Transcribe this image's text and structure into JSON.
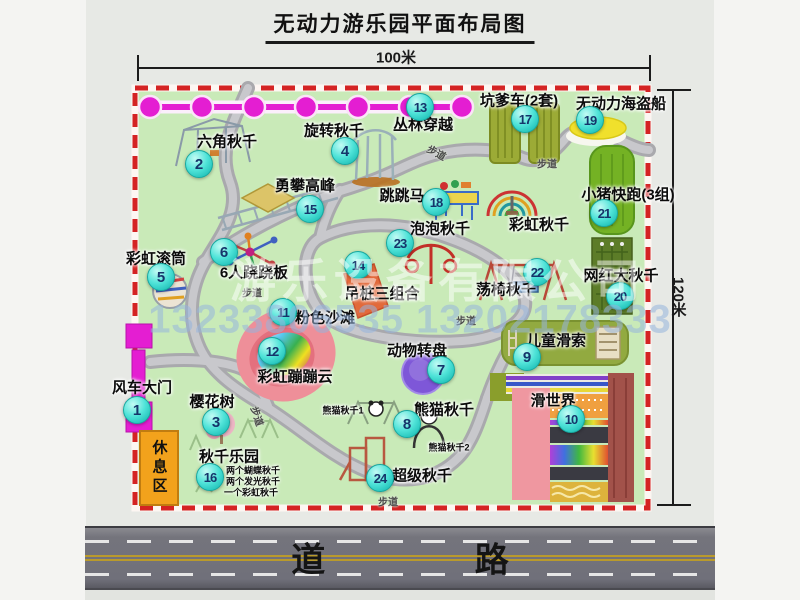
{
  "header": {
    "title": "无动力游乐园平面布局图"
  },
  "dims": {
    "width": "100米",
    "height": "120米"
  },
  "road": {
    "label": "道 路"
  },
  "watermark": {
    "company": "游乐设备有限公司",
    "phones": "13233806535 13202178333"
  },
  "rest_area": {
    "label": "休息区"
  },
  "attractions": [
    {
      "num": "1",
      "name": "风车大门",
      "mx": 137,
      "my": 410,
      "lx": 142,
      "ly": 387
    },
    {
      "num": "2",
      "name": "六角秋千",
      "mx": 199,
      "my": 164,
      "lx": 227,
      "ly": 141
    },
    {
      "num": "3",
      "name": "樱花树",
      "mx": 216,
      "my": 422,
      "lx": 212,
      "ly": 401
    },
    {
      "num": "4",
      "name": "旋转秋千",
      "mx": 345,
      "my": 151,
      "lx": 334,
      "ly": 130
    },
    {
      "num": "5",
      "name": "彩虹滚筒",
      "mx": 161,
      "my": 277,
      "lx": 156,
      "ly": 258
    },
    {
      "num": "6",
      "name": "6人跷跷板",
      "mx": 224,
      "my": 252,
      "lx": 254,
      "ly": 272
    },
    {
      "num": "7",
      "name": "动物转盘",
      "mx": 441,
      "my": 370,
      "lx": 417,
      "ly": 350
    },
    {
      "num": "8",
      "name": "熊猫秋千",
      "mx": 407,
      "my": 424,
      "lx": 444,
      "ly": 409
    },
    {
      "num": "9",
      "name": "儿童滑索",
      "mx": 527,
      "my": 357,
      "lx": 556,
      "ly": 340
    },
    {
      "num": "10",
      "name": "滑世界",
      "mx": 571,
      "my": 419,
      "lx": 553,
      "ly": 400
    },
    {
      "num": "11",
      "name": "粉色沙滩",
      "mx": 283,
      "my": 312,
      "lx": 325,
      "ly": 317
    },
    {
      "num": "12",
      "name": "彩虹蹦蹦云",
      "mx": 272,
      "my": 351,
      "lx": 295,
      "ly": 376
    },
    {
      "num": "13",
      "name": "丛林穿越",
      "mx": 420,
      "my": 107,
      "lx": 423,
      "ly": 124
    },
    {
      "num": "14",
      "name": "吊桩三组合",
      "mx": 358,
      "my": 265,
      "lx": 382,
      "ly": 293
    },
    {
      "num": "15",
      "name": "勇攀高峰",
      "mx": 310,
      "my": 209,
      "lx": 305,
      "ly": 185
    },
    {
      "num": "16",
      "name": "秋千乐园",
      "mx": 210,
      "my": 477,
      "lx": 229,
      "ly": 456
    },
    {
      "num": "17",
      "name": "坑爹车(2套)",
      "mx": 525,
      "my": 119,
      "lx": 519,
      "ly": 100
    },
    {
      "num": "18",
      "name": "跳跳马",
      "mx": 436,
      "my": 202,
      "lx": 402,
      "ly": 195
    },
    {
      "num": "19",
      "name": "无动力海盗船",
      "mx": 590,
      "my": 120,
      "lx": 621,
      "ly": 103
    },
    {
      "num": "20",
      "name": "网红大秋千",
      "mx": 620,
      "my": 296,
      "lx": 621,
      "ly": 275
    },
    {
      "num": "21",
      "name": "小猪快跑(3组)",
      "mx": 604,
      "my": 213,
      "lx": 628,
      "ly": 194
    },
    {
      "num": "22",
      "name": "荡椅秋千",
      "mx": 537,
      "my": 272,
      "lx": 506,
      "ly": 289
    },
    {
      "num": "23",
      "name": "泡泡秋千",
      "mx": 400,
      "my": 243,
      "lx": 440,
      "ly": 228
    },
    {
      "num": "24",
      "name": "超级秋千",
      "mx": 380,
      "my": 478,
      "lx": 422,
      "ly": 475
    }
  ],
  "extra_labels": [
    {
      "text": "彩虹秋千",
      "x": 539,
      "y": 224,
      "size": 15
    },
    {
      "text": "熊猫秋千1",
      "x": 343,
      "y": 410,
      "size": 9
    },
    {
      "text": "熊猫秋千2",
      "x": 449,
      "y": 447,
      "size": 9
    },
    {
      "text": "两个蝴蝶秋千",
      "x": 253,
      "y": 470,
      "size": 9
    },
    {
      "text": "两个发光秋千",
      "x": 253,
      "y": 481,
      "size": 9
    },
    {
      "text": "一个彩虹秋千",
      "x": 251,
      "y": 492,
      "size": 9
    }
  ],
  "path_labels": [
    {
      "text": "步道",
      "x": 252,
      "y": 292,
      "rot": 0
    },
    {
      "text": "步道",
      "x": 437,
      "y": 152,
      "rot": 28
    },
    {
      "text": "步道",
      "x": 547,
      "y": 163,
      "rot": 0
    },
    {
      "text": "步道",
      "x": 466,
      "y": 320,
      "rot": 0
    },
    {
      "text": "步道",
      "x": 258,
      "y": 416,
      "rot": 72
    },
    {
      "text": "步道",
      "x": 388,
      "y": 501,
      "rot": 0
    }
  ]
}
